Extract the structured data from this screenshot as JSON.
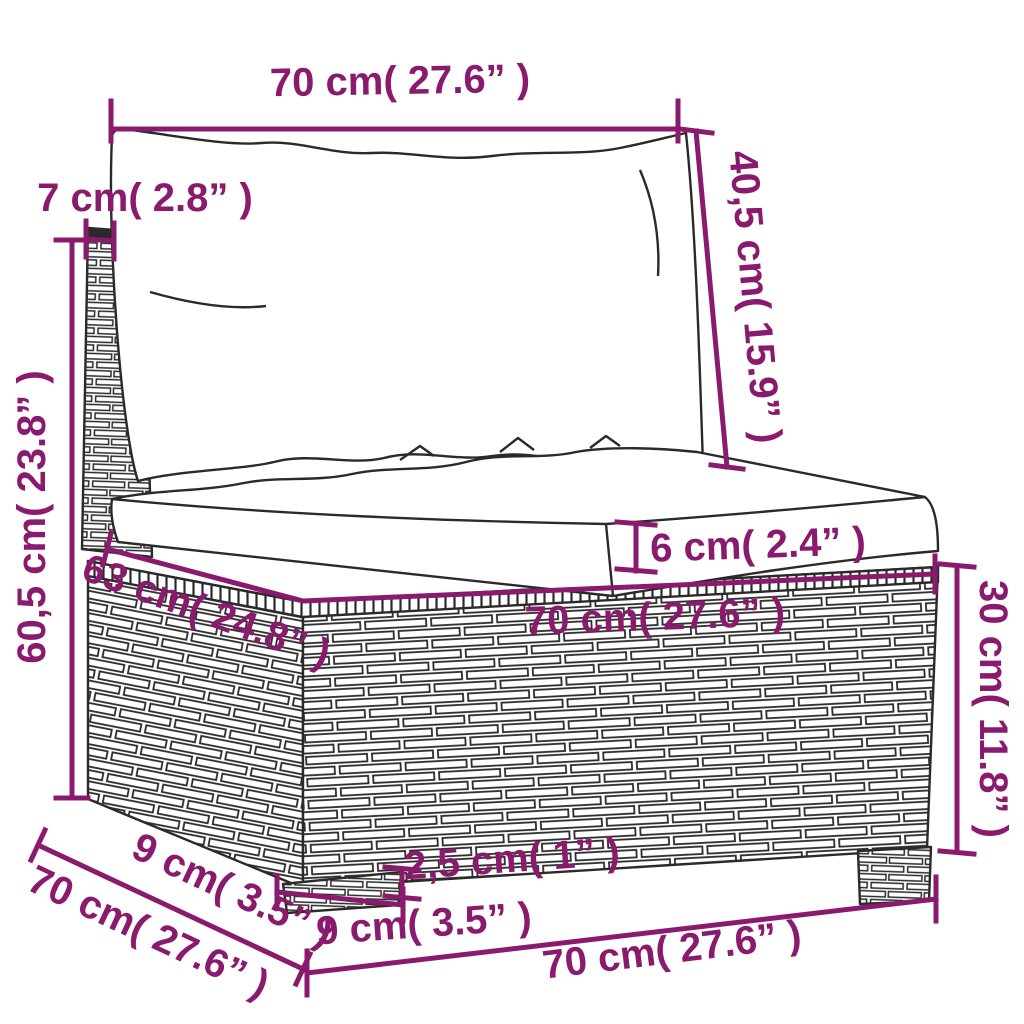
{
  "canvas": {
    "width": 1024,
    "height": 1024,
    "background": "#FFFFFF"
  },
  "colors": {
    "dimension_accent": "#8A1A6E",
    "line_art": "#2A2A2A"
  },
  "diagram": {
    "name": "wicker-sofa-section-dimension-diagram",
    "dimensions": {
      "top_width": {
        "label": "70 cm( 27.6” )"
      },
      "back_height": {
        "label": "40,5 cm( 15.9” )"
      },
      "back_depth": {
        "label": "7 cm( 2.8” )"
      },
      "total_height": {
        "label": "60,5 cm( 23.8” )"
      },
      "seat_cushion_thickness": {
        "label": "6 cm( 2.4” )"
      },
      "seat_depth": {
        "label": "63 cm( 24.8” )"
      },
      "seat_width": {
        "label": "70 cm( 27.6” )"
      },
      "base_height": {
        "label": "30 cm( 11.8” )"
      },
      "foot_height": {
        "label": "2,5 cm( 1” )"
      },
      "foot_width": {
        "label": "9 cm( 3.5” )"
      },
      "base_depth_offset": {
        "label": "9 cm( 3.5” )"
      },
      "base_depth": {
        "label": "70 cm( 27.6” )"
      },
      "base_width": {
        "label": "70 cm( 27.6” )"
      }
    }
  }
}
